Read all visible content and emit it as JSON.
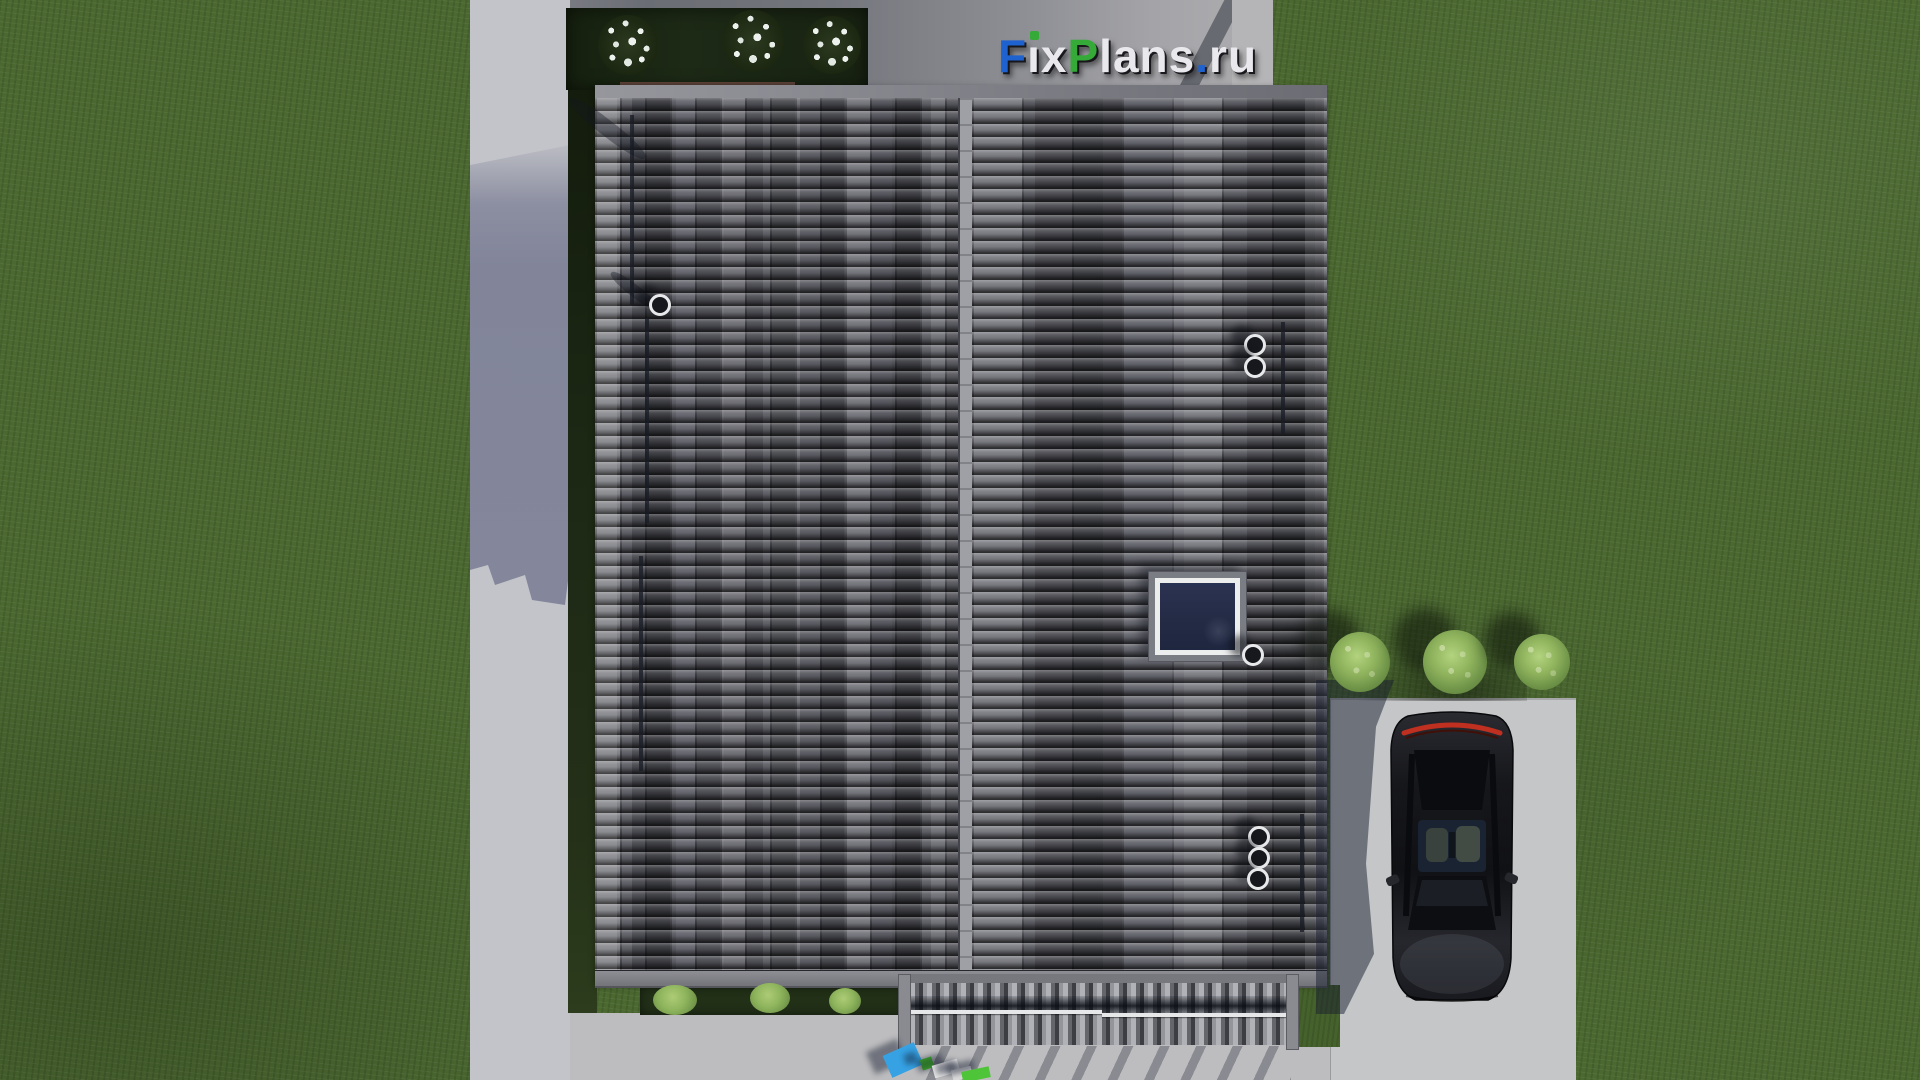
{
  "watermark": {
    "text": "FixPlans.ru",
    "letters": [
      {
        "ch": "F",
        "color": "#1e62d0"
      },
      {
        "ch": "ı",
        "color": "#e9e9ed",
        "dot": "#35aa38"
      },
      {
        "ch": "x",
        "color": "#e9e9ed"
      },
      {
        "ch": "P",
        "color": "#35aa38"
      },
      {
        "ch": "l",
        "color": "#e9e9ed"
      },
      {
        "ch": "a",
        "color": "#e9e9ed"
      },
      {
        "ch": "n",
        "color": "#e9e9ed"
      },
      {
        "ch": "s",
        "color": "#e9e9ed"
      },
      {
        "ch": ".",
        "color": "#1e62d0"
      },
      {
        "ch": "r",
        "color": "#e9e9ed"
      },
      {
        "ch": "u",
        "color": "#e9e9ed"
      }
    ]
  },
  "scene": {
    "description": "Top-down 3D architectural render: gabled tiled roof of a house with skylight and roof vents, concrete walkway on the left, flower bed with three white-flowering shrubs at top, louvered pergola over rear terrace at bottom, driveway with dark parked car and three green bushes on the right, lawn all around",
    "colors": {
      "grass": "#4b6830",
      "path_light": "#c3c4c9",
      "path_shadow": "#82859a",
      "concrete": "#bdbdbf",
      "roof_base": "#5a5b63",
      "roof_tile_light": "#9c9da5",
      "roof_tile_dark": "#3a3b43",
      "roof_seam": "#9ea0a6",
      "skylight_glass": "#232b45",
      "car_body": "#16171b",
      "taillight_red": "#c03020",
      "bush_green": "#8fb35d",
      "flower_bed": "#1d2a16"
    },
    "roof_vents": [
      {
        "x": 649,
        "y": 294
      },
      {
        "x": 1244,
        "y": 334
      },
      {
        "x": 1244,
        "y": 356
      },
      {
        "x": 1242,
        "y": 644
      },
      {
        "x": 1248,
        "y": 826
      },
      {
        "x": 1248,
        "y": 847
      },
      {
        "x": 1247,
        "y": 868
      }
    ],
    "roof_cables": [
      {
        "x": 630,
        "y": 115,
        "h": 190
      },
      {
        "x": 645,
        "y": 318,
        "h": 205
      },
      {
        "x": 639,
        "y": 556,
        "h": 215
      },
      {
        "x": 1281,
        "y": 322,
        "h": 112
      },
      {
        "x": 1300,
        "y": 814,
        "h": 118
      }
    ],
    "roof_streaks": [
      {
        "x": 575,
        "y": 93,
        "w": 95,
        "h": 16,
        "rot": 38
      },
      {
        "x": 615,
        "y": 268,
        "w": 58,
        "h": 12,
        "rot": 38
      }
    ],
    "flower_bushes": [
      {
        "x": 598,
        "y": 15,
        "s": 60
      },
      {
        "x": 722,
        "y": 10,
        "s": 62
      },
      {
        "x": 803,
        "y": 16,
        "s": 58
      }
    ],
    "green_bushes": [
      {
        "x": 1330,
        "y": 632,
        "s": 60
      },
      {
        "x": 1423,
        "y": 630,
        "s": 64
      },
      {
        "x": 1514,
        "y": 634,
        "s": 56
      }
    ],
    "bed_plants": [
      {
        "x": 653,
        "y": 985,
        "w": 44,
        "h": 30
      },
      {
        "x": 750,
        "y": 983,
        "w": 40,
        "h": 30
      },
      {
        "x": 829,
        "y": 988,
        "w": 32,
        "h": 26
      }
    ],
    "loungers": [
      {
        "x": 886,
        "y": 1048,
        "w": 34,
        "h": 24,
        "rot": -24,
        "color": "#36a2e4"
      },
      {
        "x": 921,
        "y": 1058,
        "w": 12,
        "h": 11,
        "rot": -18,
        "color": "#46c02c"
      },
      {
        "x": 933,
        "y": 1062,
        "w": 26,
        "h": 13,
        "rot": -16,
        "color": "#e6e6e6"
      },
      {
        "x": 952,
        "y": 1068,
        "w": 20,
        "h": 11,
        "rot": -14,
        "color": "#dcdcdc"
      },
      {
        "x": 962,
        "y": 1069,
        "w": 28,
        "h": 11,
        "rot": -12,
        "color": "#4ec438"
      }
    ]
  }
}
